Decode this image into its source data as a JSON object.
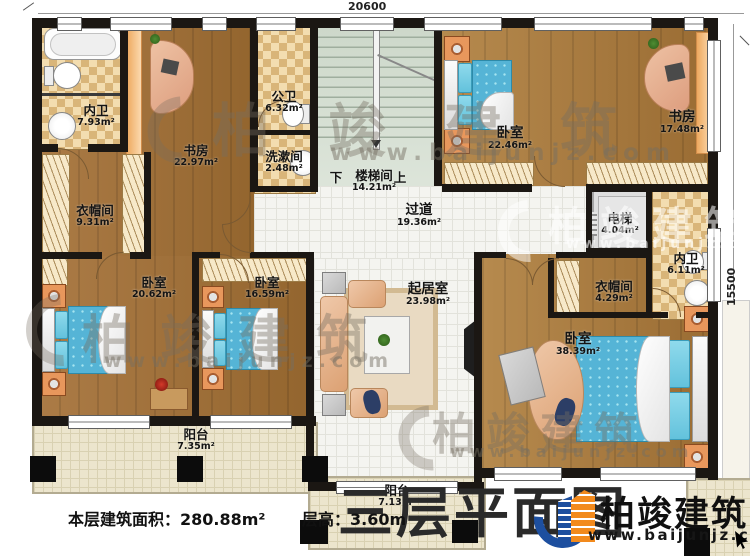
{
  "title": {
    "text": "三层平面图"
  },
  "dimensions": {
    "top": "20600",
    "right": "15500"
  },
  "footer": {
    "area_label": "本层建筑面积：280.88m²",
    "height_label": "层高：3.60m"
  },
  "logo": {
    "brand": "柏竣建筑",
    "url": "www.baijunjz.com"
  },
  "watermark": {
    "brand": "柏竣建筑",
    "url": "www.baijunjz.com"
  },
  "stairs": {
    "down": "下",
    "up": "上"
  },
  "rooms": [
    {
      "name": "内卫",
      "area": "7.93m²"
    },
    {
      "name": "书房",
      "area": "22.97m²"
    },
    {
      "name": "公卫",
      "area": "6.32m²"
    },
    {
      "name": "洗漱间",
      "area": "2.48m²"
    },
    {
      "name": "楼梯间",
      "area": "14.21m²"
    },
    {
      "name": "卧室",
      "area": "22.46m²"
    },
    {
      "name": "书房",
      "area": "17.48m²"
    },
    {
      "name": "衣帽间",
      "area": "9.31m²"
    },
    {
      "name": "过道",
      "area": "19.36m²"
    },
    {
      "name": "电梯",
      "area": "4.04m²"
    },
    {
      "name": "内卫",
      "area": "6.11m²"
    },
    {
      "name": "衣帽间",
      "area": "4.29m²"
    },
    {
      "name": "卧室",
      "area": "20.62m²"
    },
    {
      "name": "卧室",
      "area": "16.59m²"
    },
    {
      "name": "起居室",
      "area": "23.98m²"
    },
    {
      "name": "卧室",
      "area": "38.39m²"
    },
    {
      "name": "阳台",
      "area": "7.35m²"
    },
    {
      "name": "阳台",
      "area": "7.13m²"
    }
  ]
}
